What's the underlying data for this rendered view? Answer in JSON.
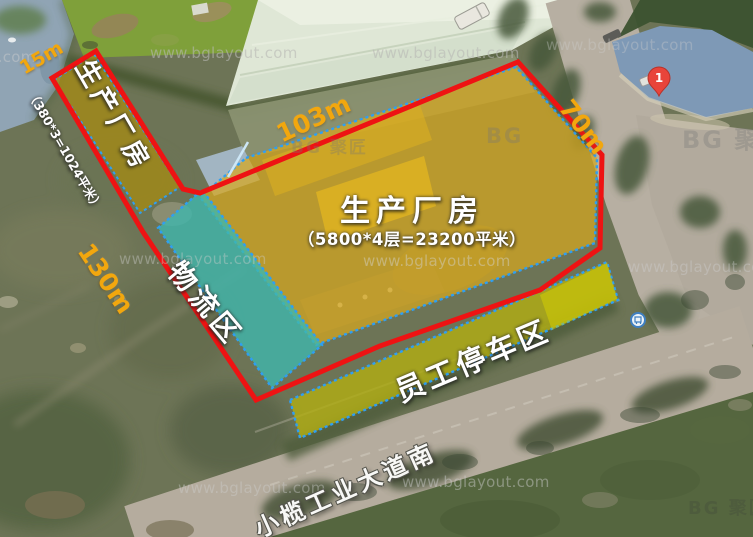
{
  "watermark": {
    "text": "www.bglayout.com",
    "logo_bg": "BG",
    "logo_cn": "聚匠"
  },
  "marker": {
    "label": "1"
  },
  "road": {
    "label": "小榄工业大道南"
  },
  "zones": {
    "main_factory": {
      "label": "生产厂房",
      "area": "（5800*4层=23200平米）",
      "fill": "#d7a71f"
    },
    "strip_factory": {
      "label": "生产厂房",
      "area": "（380*3=1024平米）",
      "fill": "#a48a14"
    },
    "logistics": {
      "label": "物流区",
      "fill": "#3fb7ad"
    },
    "parking": {
      "label": "员工停车区",
      "fill": "#b2ae12"
    }
  },
  "dimensions": {
    "top_left": "15m",
    "top": "103m",
    "right": "70m",
    "left": "130m"
  },
  "colors": {
    "boundary_red": "#ee1313",
    "dashed_blue": "#2f9ff2",
    "dimension_orange": "#f2a70e"
  }
}
